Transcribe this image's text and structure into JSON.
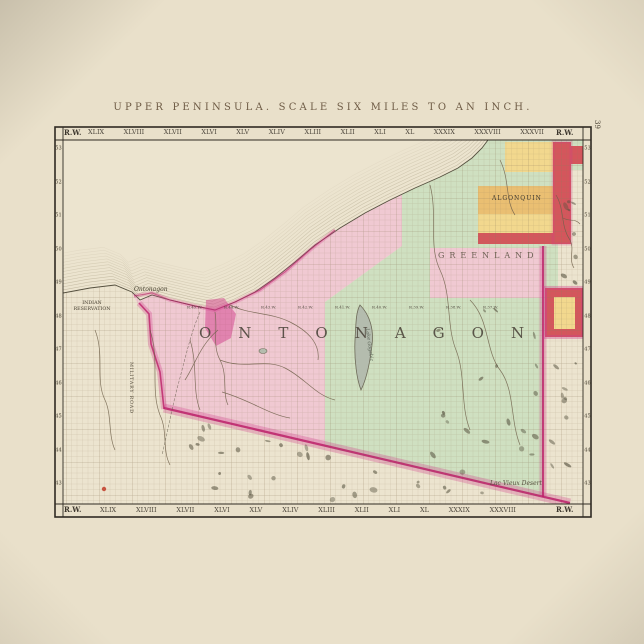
{
  "page": {
    "page_number": "39"
  },
  "plate": {
    "title": "UPPER PENINSULA. SCALE SIX MILES TO AN INCH.",
    "corner_label": "R.W.",
    "top_range_numerals": [
      "XLIX",
      "XLVIII",
      "XLVII",
      "XLVI",
      "XLV",
      "XLIV",
      "XLIII",
      "XLII",
      "XLI",
      "XL",
      "XXXIX",
      "XXXVIII",
      "XXXVII"
    ],
    "bottom_range_numerals": [
      "XLIX",
      "XLVIII",
      "XLVII",
      "XLVI",
      "XLV",
      "XLIV",
      "XLIII",
      "XLII",
      "XLI",
      "XL",
      "XXXIX",
      "XXXVIII"
    ],
    "township_row_numbers": [
      "53",
      "52",
      "51",
      "50",
      "49",
      "48",
      "47",
      "46",
      "45",
      "44",
      "43"
    ]
  },
  "map": {
    "county_name": "ONTONAGON",
    "township_name_spread": "GREENLAND",
    "range_labels": [
      "R.45.W.",
      "R.44.W.",
      "R.43.W.",
      "R.42.W.",
      "R.41.W.",
      "R.40.W.",
      "R.39.W.",
      "R.38.W.",
      "R.37.W."
    ],
    "labels": {
      "algonquin": "ALGONQUIN",
      "village": "Ontonagon",
      "indian_reservation_line1": "INDIAN",
      "indian_reservation_line2": "RESERVATION",
      "lac_vieux_desert": "Lac Vieux Desert",
      "military_road": "MILITARY ROAD",
      "lake_gogebic": "Lake Gogebic"
    },
    "colors": {
      "paper": "#ece4cf",
      "poster": "#e9e0ca",
      "pink": "#f0c9d2",
      "green": "#cfe0c1",
      "yellow": "#f2d88e",
      "orange": "#eabf72",
      "red": "#d4565c",
      "magenta": "#bb2168",
      "magenta_glow": "#d23d8c",
      "ink": "#3b352c",
      "grid": "#8d7a5c",
      "water_hachure": "#a3987c",
      "lake": "#b4bcae",
      "river": "#6f604a",
      "swamp": "#56523f"
    }
  }
}
